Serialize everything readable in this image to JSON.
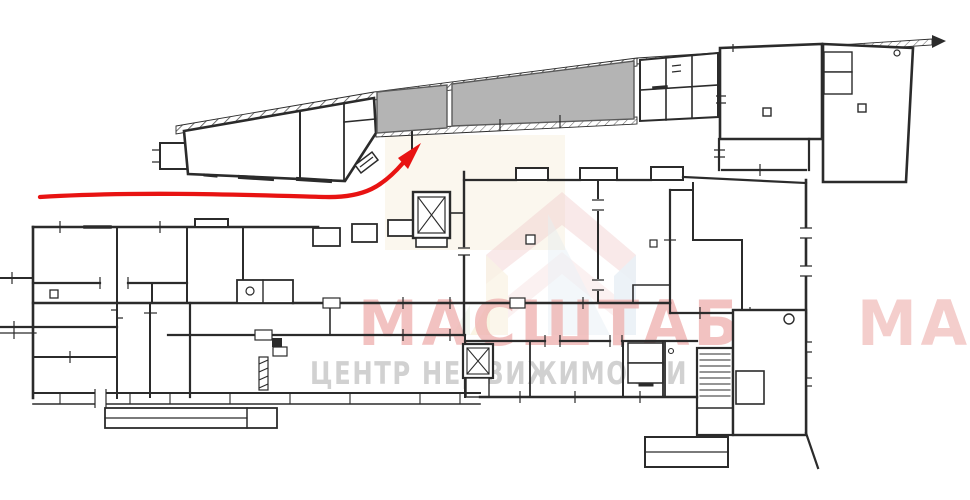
{
  "watermark": {
    "title": "МАСШТАБ",
    "title_tile_fragment": "МАСШТАБ",
    "subtitle": "ЦЕНТР НЕДВИЖИМОСТИ"
  },
  "colors": {
    "wall": "#2b2b2b",
    "wall_soft": "#555555",
    "shaded_room": "#b4b4b4",
    "shaded_room_border": "#5a5a5a",
    "route_arrow": "#e81312",
    "watermark_title": "#efb4b2",
    "watermark_subtitle": "#c9c9c9",
    "logo_pink": "#f0cccc",
    "logo_pink_light": "#f5dcdc",
    "logo_cream": "#f4ebd2",
    "logo_blue": "#d9e6ef",
    "logo_yellow": "#f2e9c4",
    "logo_green": "#dfead6",
    "courtyard_tint": "#f8efdd"
  }
}
